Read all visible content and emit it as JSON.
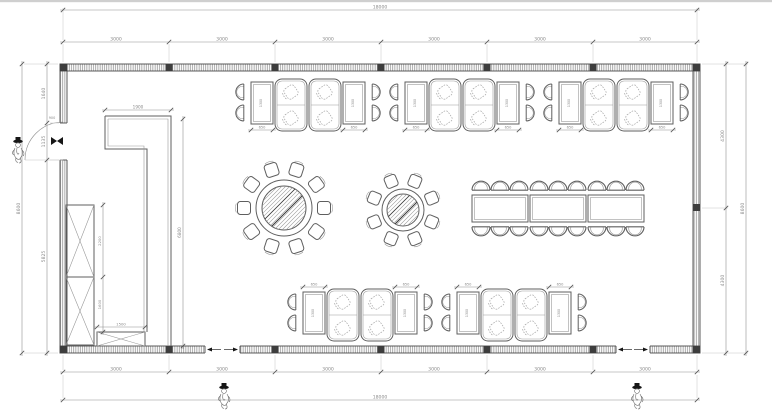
{
  "drawing": {
    "type": "banquet-hall-floor-plan",
    "canvas": {
      "width": 772,
      "height": 414
    }
  },
  "colors": {
    "line": "#5f5f5f",
    "wall": "#4a4a4a",
    "dimension": "#8f8f8f",
    "text": "#8a8a8a",
    "accent_dark": "#161616"
  },
  "dimensions": {
    "top_total": "18000",
    "top_segments": [
      "3000",
      "3000",
      "3000",
      "3000",
      "3000",
      "3000"
    ],
    "bottom_total": "18000",
    "bottom_segments": [
      "3000",
      "3000",
      "3000",
      "3000",
      "3000",
      "3000"
    ],
    "left_total": "8600",
    "left_segments": [
      "1640",
      "1135",
      "5825"
    ],
    "right_total": "8600",
    "right_segments": [
      "4300",
      "4300"
    ],
    "door_width": "900",
    "partition_width": "1900",
    "partition_drop": "6800",
    "cabinet_upper_height": "2200",
    "cabinet_lower_height": "1600",
    "cabinet_lower_width": "1500",
    "booth_table_width": "650",
    "booth_table_length": "1300"
  },
  "furniture": {
    "booth_groups_top": 3,
    "booth_groups_bottom": 2,
    "round_table_large_seats": 10,
    "round_table_small_seats": 8,
    "banquet_tables": 3,
    "banquet_seats": 18,
    "tall_cabinet_sections": 2,
    "low_cabinet_sections": 1,
    "entrance_figures": 3
  }
}
